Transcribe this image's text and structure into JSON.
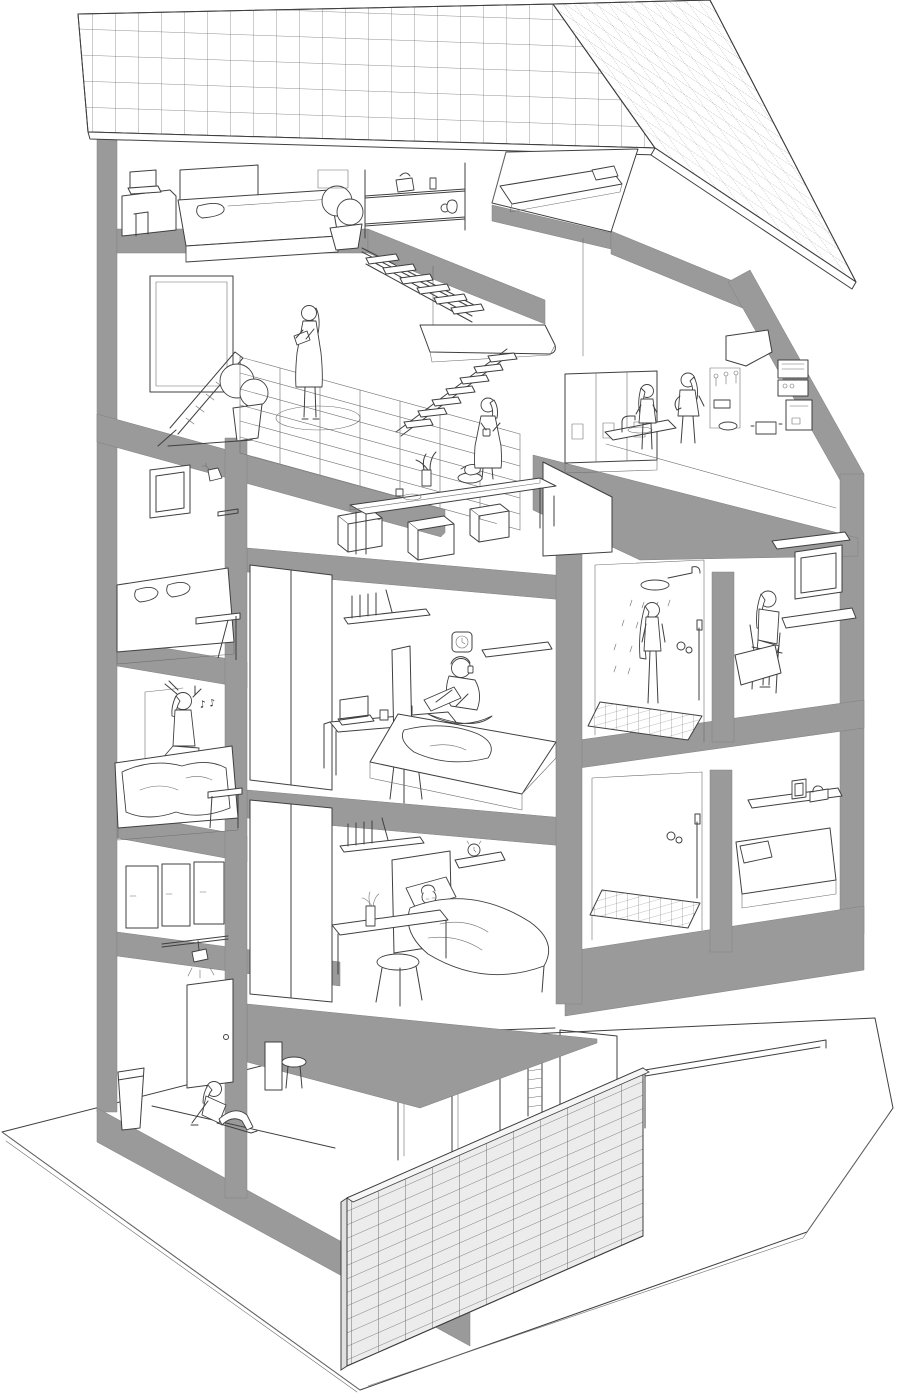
{
  "meta": {
    "title": "Share house cross-section illustration",
    "image_type": "architectural cutaway axonometric line drawing",
    "style": "black-and-white outline drawing with gray structural slabs"
  },
  "palette": {
    "background": "#ffffff",
    "line": "#3f3f3f",
    "structure_gray": "#9a9a9a",
    "tile_fill": "#ececec",
    "grid_line": "#6e6e6e",
    "white": "#ffffff"
  },
  "annotations": {
    "sleep_zzz": "Z z",
    "music_notes": "♪ ♪"
  },
  "building": {
    "floors_visible": 5,
    "people_visible": 10,
    "roof": "grid-tiled double-pitch roof with loft window opening",
    "exterior": [
      "tiled screen wall at street level",
      "concrete base slab"
    ]
  },
  "rooms": [
    {
      "id": "attic-bedroom",
      "label": "Attic bedroom",
      "furniture": [
        "desk with laptop",
        "double bed",
        "headboard",
        "potted plant",
        "wall shelves with bag and vases",
        "ceiling light panels"
      ]
    },
    {
      "id": "attic-loft",
      "label": "Roof loft",
      "furniture": [
        "mattress with pillow under roof opening"
      ]
    },
    {
      "id": "living-mezzanine",
      "label": "Living mezzanine",
      "activity": "woman standing reading a book",
      "furniture": [
        "picture window",
        "lounge chair",
        "potted plant",
        "round rug",
        "glass balustrade",
        "open riser stairs",
        "landing platform"
      ]
    },
    {
      "id": "dining",
      "label": "Dining area",
      "activity": "woman standing holding a mug",
      "furniture": [
        "long dining table",
        "cube stools",
        "flower vase",
        "fruit bowl",
        "kettle",
        "cup and plate"
      ]
    },
    {
      "id": "kitchen",
      "label": "Shared kitchen",
      "activity": "two women chatting",
      "furniture": [
        "refrigerator lockers",
        "sink with faucet",
        "hanging utensils",
        "range hood",
        "oven and microwave",
        "coffee machine",
        "pot",
        "bowl"
      ]
    },
    {
      "id": "room-window",
      "label": "Small room with window",
      "furniture": [
        "window niche",
        "wall lamp",
        "small shelf",
        "bed with two pillows",
        "fold-down desk"
      ]
    },
    {
      "id": "room-music",
      "label": "Room with music",
      "activity": "woman kneeling on bed listening to headphones",
      "furniture": [
        "bed with rumpled blanket",
        "side table"
      ]
    },
    {
      "id": "room-sketching",
      "label": "Room with sketcher",
      "activity": "person sitting cross-legged on bed drawing with headphones",
      "furniture": [
        "wardrobe",
        "bookshelf",
        "wall clock",
        "picture ledge",
        "desk with laptop",
        "stool",
        "bed"
      ]
    },
    {
      "id": "shower-room",
      "label": "Shower room",
      "activity": "woman showering under rain head",
      "furniture": [
        "rain shower head",
        "hand shower",
        "controls",
        "tiled shower floor"
      ]
    },
    {
      "id": "room-study",
      "label": "Study room",
      "activity": "woman seated at wall desk",
      "furniture": [
        "window with shelf",
        "wall-mounted desk",
        "chair",
        "bed corner"
      ]
    },
    {
      "id": "room-sleeping",
      "label": "Sleeping room",
      "activity": "person asleep in bed",
      "furniture": [
        "wardrobe",
        "bookshelf",
        "headboard",
        "pillow",
        "blanket",
        "wall shelf with alarm clock",
        "desk with pencil cup",
        "stool"
      ]
    },
    {
      "id": "bathroom",
      "label": "Lower shower room",
      "furniture": [
        "hand shower",
        "controls",
        "tiled shower floor"
      ]
    },
    {
      "id": "room-bed-right",
      "label": "Small bedroom",
      "furniture": [
        "wall shelf with photo frame and radio",
        "bed with pillow"
      ]
    },
    {
      "id": "entrance-hall",
      "label": "Entrance hall",
      "activity": "woman sitting on the floor",
      "furniture": [
        "front door",
        "track light",
        "umbrella bin",
        "bench stool",
        "closet fronts"
      ]
    },
    {
      "id": "ground-floor",
      "label": "Ground floor / street level",
      "furniture": [
        "ladder",
        "partition walls",
        "tiled screen wall",
        "base slab"
      ]
    }
  ]
}
